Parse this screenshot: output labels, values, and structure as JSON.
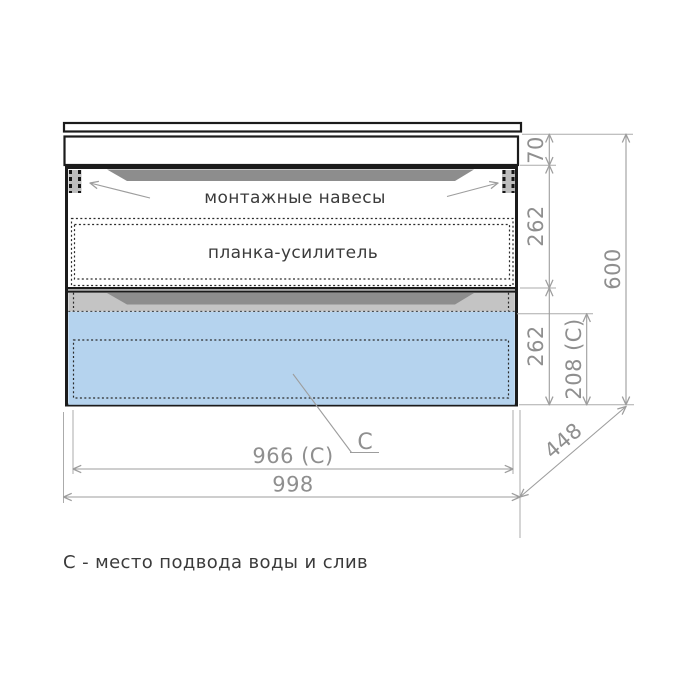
{
  "diagram": {
    "type": "furniture-dimension-drawing",
    "labels": {
      "mounting_hangers": "монтажные навесы",
      "reinforcement_plank": "планка-усилитель",
      "connection_marker": "C",
      "footnote": "С - место подвода воды и слив"
    },
    "dimensions": {
      "front_panel_height": "70",
      "upper_drawer_height": "262",
      "lower_drawer_height": "262",
      "connection_height": "208 (C)",
      "total_height": "600",
      "connection_width": "966 (C)",
      "total_width": "998",
      "depth": "448"
    },
    "colors": {
      "outline_black": "#1b1b1b",
      "dimension_gray": "#9d9d9d",
      "dimension_text_gray": "#8f8f8f",
      "label_text": "#3b3b3b",
      "connection_area_blue": "#b5d3ee",
      "drawer_band_gray": "#c4c4c4",
      "handle_groove_gray": "#8d8d8d",
      "plank_gray": "#d6d6d6",
      "hanger_gray": "#bdbdbd"
    }
  }
}
